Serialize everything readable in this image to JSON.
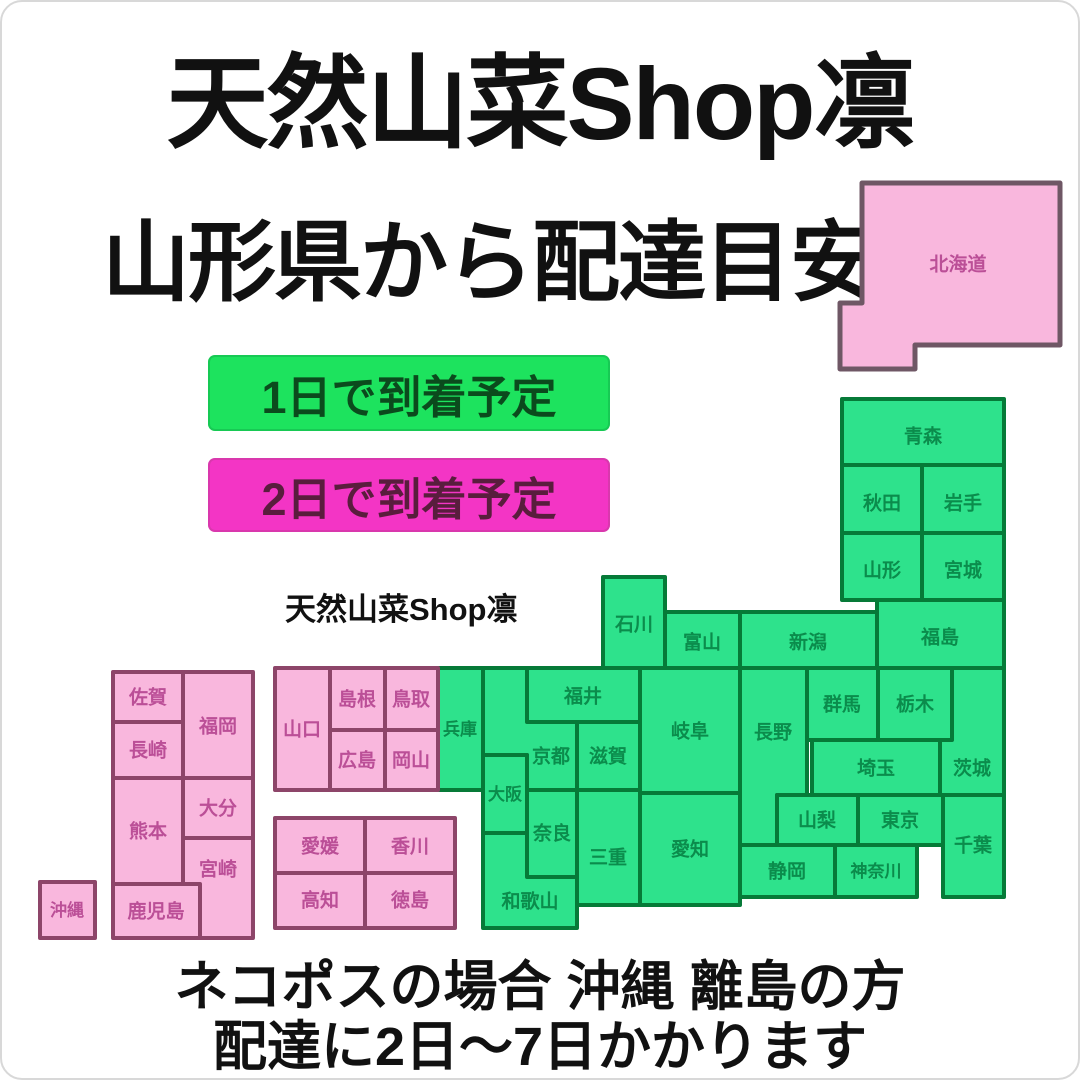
{
  "title": "天然山菜Shop凛",
  "subtitle": "山形県から配達目安",
  "legend": {
    "one_day": "1日で到着予定",
    "two_day": "2日で到着予定"
  },
  "watermark": "天然山菜Shop凛",
  "footer": {
    "line1": "ネコポスの場合 沖縄 離島の方",
    "line2": "配達に2日〜7日かかります"
  },
  "colors": {
    "green-fill": "#2ee28c",
    "green-border": "#067a38",
    "green-text": "#0b8c4c",
    "pink-fill": "#f9b7dd",
    "pink-border": "#8d4569",
    "pink-text": "#bb4f97",
    "hokkaido-border": "#6f5765",
    "legend-green": "#1de35e",
    "legend-green-text": "#0b4a1d",
    "legend-pink": "#f335c5",
    "legend-pink-text": "#591d3d"
  },
  "map": {
    "delivery_1day_color": "green",
    "delivery_2day_color": "pink",
    "prefectures": {
      "hokkaido": "北海道",
      "aomori": "青森",
      "akita": "秋田",
      "iwate": "岩手",
      "yamagata": "山形",
      "miyagi": "宮城",
      "fukushima": "福島",
      "niigata": "新潟",
      "toyama": "富山",
      "ishikawa": "石川",
      "fukui": "福井",
      "gifu": "岐阜",
      "nagano": "長野",
      "gunma": "群馬",
      "tochigi": "栃木",
      "ibaraki": "茨城",
      "saitama": "埼玉",
      "tokyo": "東京",
      "chiba": "千葉",
      "kanagawa": "神奈川",
      "yamanashi": "山梨",
      "shizuoka": "静岡",
      "aichi": "愛知",
      "mie": "三重",
      "shiga": "滋賀",
      "kyoto": "京都",
      "osaka": "大阪",
      "nara": "奈良",
      "wakayama": "和歌山",
      "hyogo": "兵庫",
      "tottori": "鳥取",
      "shimane": "島根",
      "okayama": "岡山",
      "hiroshima": "広島",
      "yamaguchi": "山口",
      "kagawa": "香川",
      "tokushima": "徳島",
      "ehime": "愛媛",
      "kochi": "高知",
      "fukuoka": "福岡",
      "saga": "佐賀",
      "nagasaki": "長崎",
      "oita": "大分",
      "kumamoto": "熊本",
      "miyazaki": "宮崎",
      "kagoshima": "鹿児島",
      "okinawa": "沖縄"
    }
  }
}
